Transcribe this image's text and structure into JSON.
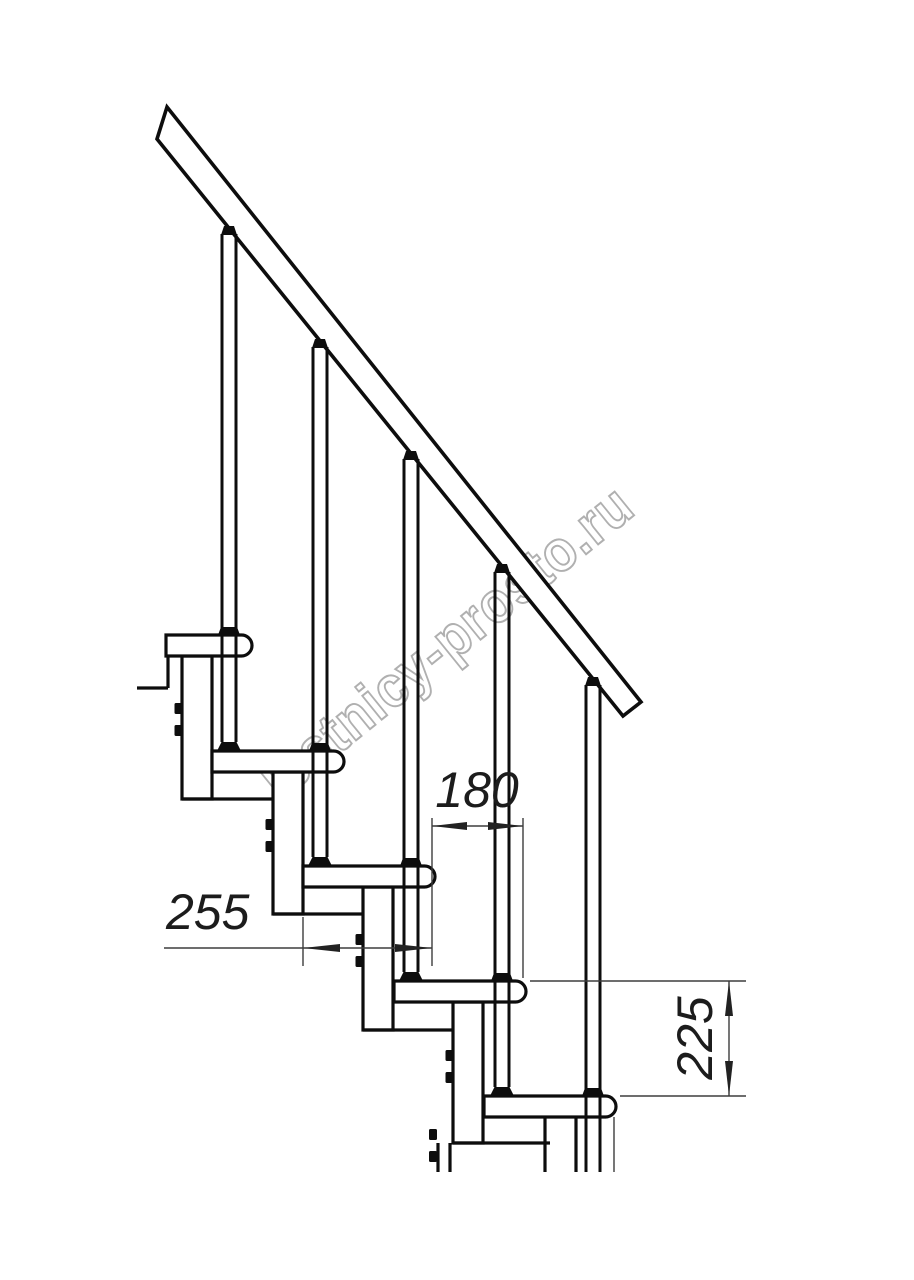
{
  "drawing": {
    "type": "technical-drawing",
    "subject": "modular-staircase-side-view",
    "watermark": "lestnicy-prosto.ru",
    "dimensions": {
      "tread_depth": "255",
      "step_offset": "180",
      "step_rise": "225"
    },
    "colors": {
      "background": "#ffffff",
      "structure_line": "#0d0d0d",
      "dimension_line": "#3d3d3d",
      "dimension_text": "#1c1c1c",
      "watermark": "#b0b0b0"
    }
  }
}
